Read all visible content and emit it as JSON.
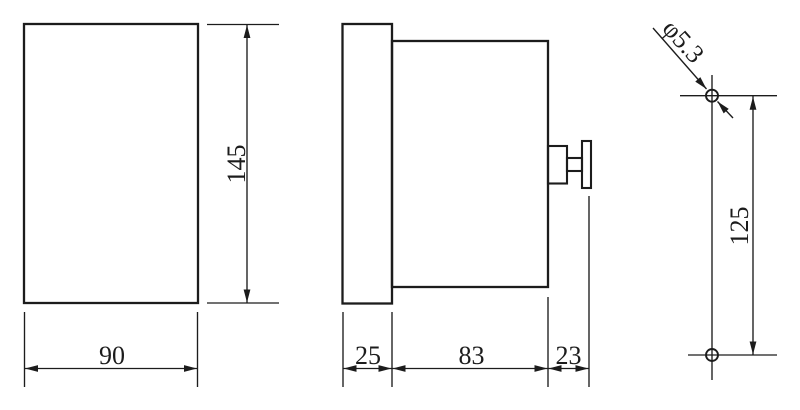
{
  "colors": {
    "line": "#1c1c1c",
    "background": "#ffffff"
  },
  "views": {
    "front": {
      "width_label": "90",
      "height_label": "145"
    },
    "side": {
      "bezel_depth_label": "25",
      "body_depth_label": "83",
      "knob_depth_label": "23"
    },
    "mounting": {
      "hole_diameter_label": "φ5.3",
      "hole_spacing_label": "125"
    }
  }
}
